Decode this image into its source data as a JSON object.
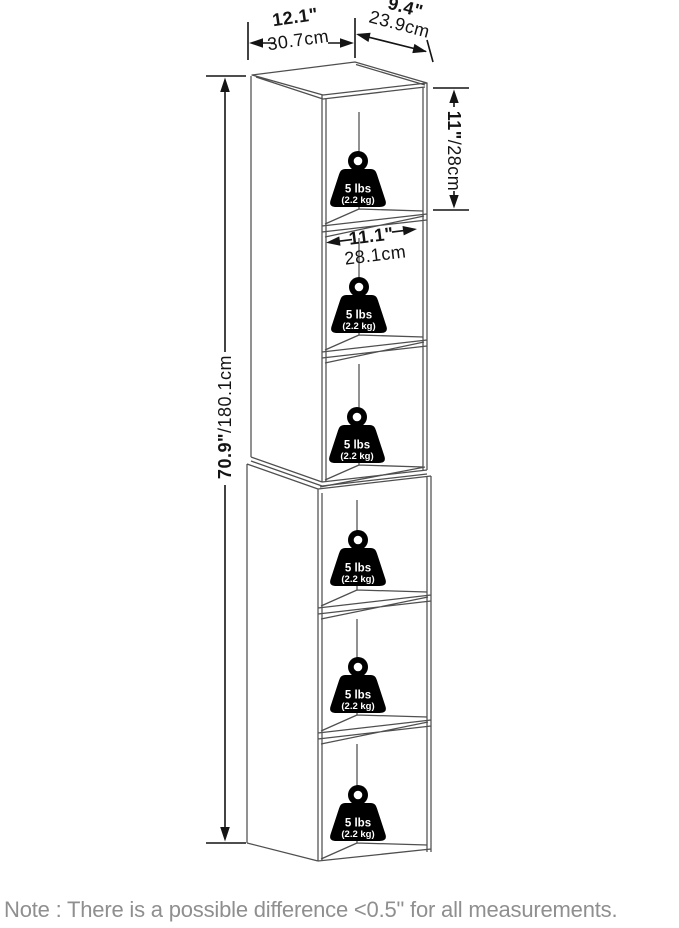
{
  "dimensions": {
    "overall_width": {
      "inches": "12.1\"",
      "cm": "30.7cm"
    },
    "overall_depth": {
      "inches": "9.4\"",
      "cm": "23.9cm"
    },
    "overall_height": {
      "inches": "70.9\"",
      "cm_suffix": "/180.1cm"
    },
    "cubby_height": {
      "inches": "11\"",
      "cm_suffix": "/28cm"
    },
    "cubby_width": {
      "inches": "11.1\"",
      "cm": "28.1cm"
    }
  },
  "shelf_capacity": {
    "lbs": "5 lbs",
    "kg": "(2.2 kg)",
    "shelf_count": 6
  },
  "note": "Note : There is a possible difference <0.5\" for all measurements.",
  "colors": {
    "cabinet_line": "#4f4f4f",
    "dimension_line": "#141414",
    "weight_fill": "#000000",
    "weight_text": "#ffffff",
    "note_text": "#8f8f8f",
    "background": "#ffffff"
  }
}
